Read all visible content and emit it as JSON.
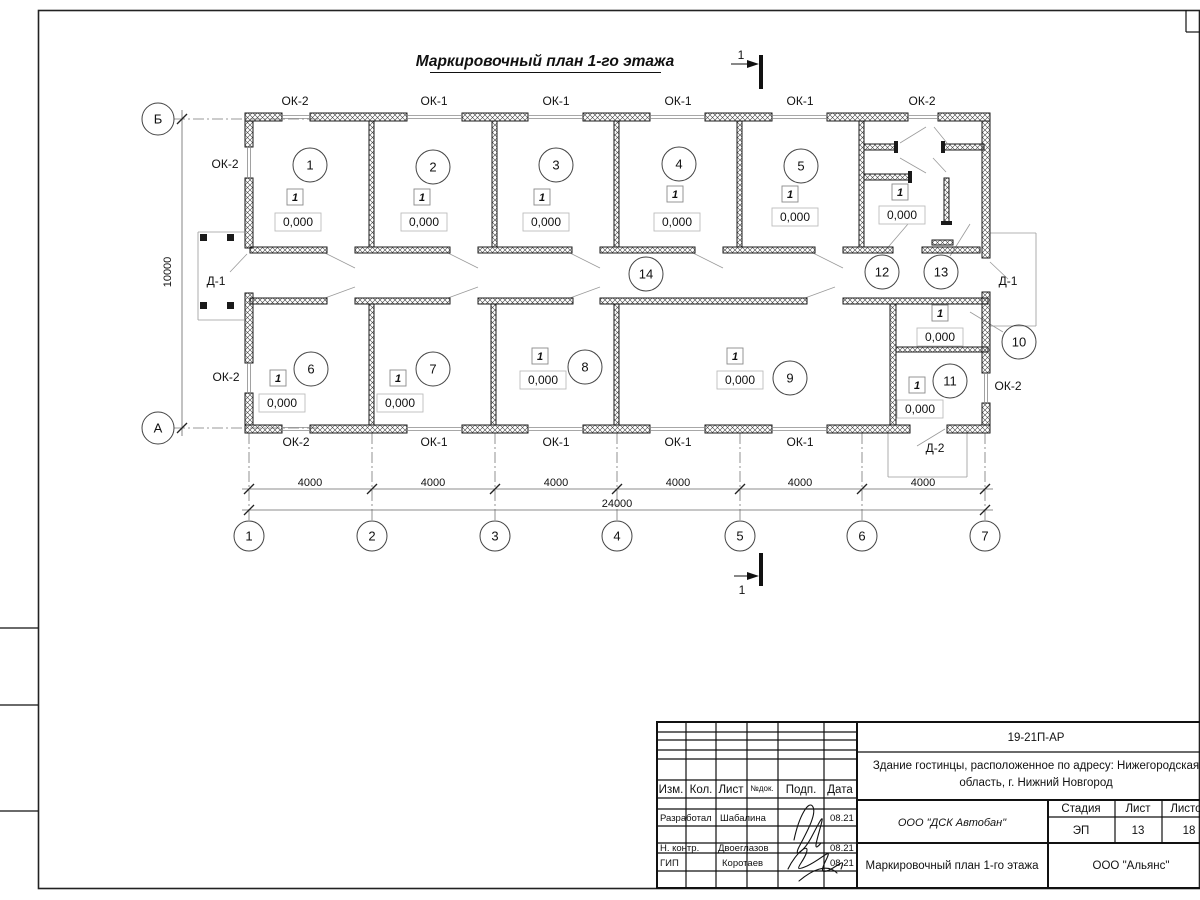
{
  "drawing_title": "Маркировочный план 1-го этажа",
  "section_cut": {
    "label": "1"
  },
  "axes": {
    "cols": [
      {
        "label": "1",
        "x": 249
      },
      {
        "label": "2",
        "x": 372
      },
      {
        "label": "3",
        "x": 495
      },
      {
        "label": "4",
        "x": 617
      },
      {
        "label": "5",
        "x": 740
      },
      {
        "label": "6",
        "x": 862
      },
      {
        "label": "7",
        "x": 985
      }
    ],
    "rows": [
      {
        "label": "Б",
        "y": 119
      },
      {
        "label": "А",
        "y": 428
      }
    ]
  },
  "dims": {
    "bays": [
      {
        "text": "4000",
        "x": 310
      },
      {
        "text": "4000",
        "x": 433
      },
      {
        "text": "4000",
        "x": 556
      },
      {
        "text": "4000",
        "x": 678
      },
      {
        "text": "4000",
        "x": 800
      },
      {
        "text": "4000",
        "x": 923
      }
    ],
    "total": {
      "text": "24000",
      "x": 617,
      "y": 507
    },
    "left": {
      "text": "10000",
      "x": 171,
      "y": 272
    },
    "bay_text_y": 486
  },
  "openings": [
    {
      "text": "ОК-2",
      "x": 295,
      "y": 101
    },
    {
      "text": "ОК-1",
      "x": 434,
      "y": 101
    },
    {
      "text": "ОК-1",
      "x": 556,
      "y": 101
    },
    {
      "text": "ОК-1",
      "x": 678,
      "y": 101
    },
    {
      "text": "ОК-1",
      "x": 800,
      "y": 101
    },
    {
      "text": "ОК-2",
      "x": 922,
      "y": 101
    },
    {
      "text": "ОК-2",
      "x": 296,
      "y": 442
    },
    {
      "text": "ОК-1",
      "x": 434,
      "y": 442
    },
    {
      "text": "ОК-1",
      "x": 556,
      "y": 442
    },
    {
      "text": "ОК-1",
      "x": 678,
      "y": 442
    },
    {
      "text": "ОК-1",
      "x": 800,
      "y": 442
    },
    {
      "text": "ОК-2",
      "x": 225,
      "y": 164
    },
    {
      "text": "ОК-2",
      "x": 226,
      "y": 377
    },
    {
      "text": "Д-1",
      "x": 216,
      "y": 281
    },
    {
      "text": "ОК-2",
      "x": 1008,
      "y": 386
    },
    {
      "text": "Д-1",
      "x": 1008,
      "y": 281
    },
    {
      "text": "Д-2",
      "x": 935,
      "y": 448
    }
  ],
  "rooms": [
    {
      "n": "1",
      "cx": 310,
      "cy": 165,
      "marker": "1",
      "mx": 295,
      "my": 197,
      "elev": "0,000",
      "ex": 298,
      "ey": 222
    },
    {
      "n": "2",
      "cx": 433,
      "cy": 167,
      "marker": "1",
      "mx": 422,
      "my": 197,
      "elev": "0,000",
      "ex": 424,
      "ey": 222
    },
    {
      "n": "3",
      "cx": 556,
      "cy": 165,
      "marker": "1",
      "mx": 542,
      "my": 197,
      "elev": "0,000",
      "ex": 546,
      "ey": 222
    },
    {
      "n": "4",
      "cx": 679,
      "cy": 164,
      "marker": "1",
      "mx": 675,
      "my": 194,
      "elev": "0,000",
      "ex": 677,
      "ey": 222
    },
    {
      "n": "5",
      "cx": 801,
      "cy": 166,
      "marker": "1",
      "mx": 790,
      "my": 194,
      "elev": "0,000",
      "ex": 795,
      "ey": 217
    },
    {
      "n": "6",
      "cx": 311,
      "cy": 369,
      "marker": "1",
      "mx": 278,
      "my": 378,
      "elev": "0,000",
      "ex": 282,
      "ey": 403
    },
    {
      "n": "7",
      "cx": 433,
      "cy": 369,
      "marker": "1",
      "mx": 398,
      "my": 378,
      "elev": "0,000",
      "ex": 400,
      "ey": 403
    },
    {
      "n": "8",
      "cx": 585,
      "cy": 367,
      "marker": "1",
      "mx": 540,
      "my": 356,
      "elev": "0,000",
      "ex": 543,
      "ey": 380
    },
    {
      "n": "9",
      "cx": 790,
      "cy": 378,
      "marker": "1",
      "mx": 735,
      "my": 356,
      "elev": "0,000",
      "ex": 740,
      "ey": 380
    },
    {
      "n": "10",
      "cx": 1019,
      "cy": 342,
      "marker": "1",
      "mx": 940,
      "my": 313,
      "elev": "0,000",
      "ex": 940,
      "ey": 337
    },
    {
      "n": "11",
      "cx": 950,
      "cy": 381,
      "marker": "1",
      "mx": 917,
      "my": 385,
      "elev": "0,000",
      "ex": 920,
      "ey": 409
    },
    {
      "n": "12",
      "cx": 882,
      "cy": 272,
      "marker": "1",
      "mx": 900,
      "my": 192,
      "elev": "0,000",
      "ex": 902,
      "ey": 215
    },
    {
      "n": "13",
      "cx": 941,
      "cy": 272
    },
    {
      "n": "14",
      "cx": 646,
      "cy": 274
    }
  ],
  "plan": {
    "walls": [
      [
        245,
        113,
        37,
        8
      ],
      [
        310,
        113,
        97,
        8
      ],
      [
        462,
        113,
        66,
        8
      ],
      [
        583,
        113,
        67,
        8
      ],
      [
        705,
        113,
        67,
        8
      ],
      [
        827,
        113,
        81,
        8
      ],
      [
        938,
        113,
        52,
        8
      ],
      [
        245,
        425,
        37,
        8
      ],
      [
        310,
        425,
        97,
        8
      ],
      [
        462,
        425,
        66,
        8
      ],
      [
        583,
        425,
        67,
        8
      ],
      [
        705,
        425,
        67,
        8
      ],
      [
        827,
        425,
        83,
        8
      ],
      [
        947,
        425,
        43,
        8
      ],
      [
        245,
        121,
        8,
        26
      ],
      [
        245,
        178,
        8,
        70
      ],
      [
        245,
        293,
        8,
        70
      ],
      [
        245,
        393,
        8,
        32
      ],
      [
        982,
        121,
        8,
        137
      ],
      [
        982,
        292,
        8,
        81
      ],
      [
        982,
        403,
        8,
        22
      ],
      [
        369,
        121,
        5,
        126
      ],
      [
        492,
        121,
        5,
        126
      ],
      [
        614,
        121,
        5,
        126
      ],
      [
        737,
        121,
        5,
        126
      ],
      [
        859,
        121,
        5,
        126
      ],
      [
        250,
        247,
        77,
        6
      ],
      [
        355,
        247,
        95,
        6
      ],
      [
        478,
        247,
        94,
        6
      ],
      [
        600,
        247,
        95,
        6
      ],
      [
        723,
        247,
        92,
        6
      ],
      [
        843,
        247,
        50,
        6
      ],
      [
        922,
        247,
        58,
        6
      ],
      [
        250,
        298,
        77,
        6
      ],
      [
        355,
        298,
        95,
        6
      ],
      [
        478,
        298,
        95,
        6
      ],
      [
        600,
        298,
        207,
        6
      ],
      [
        843,
        298,
        145,
        6
      ],
      [
        369,
        304,
        5,
        121
      ],
      [
        491,
        304,
        5,
        121
      ],
      [
        614,
        304,
        5,
        121
      ],
      [
        890,
        304,
        6,
        121
      ],
      [
        896,
        347,
        92,
        5
      ],
      [
        864,
        144,
        32,
        6
      ],
      [
        864,
        174,
        46,
        6
      ],
      [
        943,
        144,
        41,
        6
      ],
      [
        944,
        178,
        5,
        45
      ],
      [
        932,
        240,
        21,
        5
      ]
    ],
    "caps": [
      [
        894,
        141,
        4,
        12
      ],
      [
        908,
        171,
        4,
        12
      ],
      [
        941,
        141,
        4,
        12
      ],
      [
        941,
        221,
        11,
        4
      ]
    ],
    "win": [
      [
        "h",
        282,
        310,
        113
      ],
      [
        "h",
        407,
        462,
        113
      ],
      [
        "h",
        528,
        583,
        113
      ],
      [
        "h",
        650,
        705,
        113
      ],
      [
        "h",
        772,
        827,
        113
      ],
      [
        "h",
        908,
        938,
        113
      ],
      [
        "h",
        282,
        310,
        425
      ],
      [
        "h",
        407,
        462,
        425
      ],
      [
        "h",
        528,
        583,
        425
      ],
      [
        "h",
        650,
        705,
        425
      ],
      [
        "h",
        772,
        827,
        425
      ],
      [
        "v",
        147,
        178,
        245
      ],
      [
        "v",
        363,
        393,
        245
      ],
      [
        "v",
        373,
        403,
        982
      ]
    ],
    "thin": [
      [
        198,
        232,
        244,
        232
      ],
      [
        198,
        232,
        198,
        320
      ],
      [
        198,
        320,
        244,
        320
      ],
      [
        990,
        233,
        1036,
        233
      ],
      [
        1036,
        233,
        1036,
        326
      ],
      [
        990,
        326,
        1036,
        326
      ],
      [
        888,
        430,
        888,
        477
      ],
      [
        888,
        477,
        967,
        477
      ],
      [
        967,
        430,
        967,
        477
      ],
      [
        230,
        272,
        247,
        254
      ],
      [
        1008,
        279,
        990,
        262
      ],
      [
        917,
        446,
        945,
        429
      ],
      [
        884,
        252,
        908,
        224
      ],
      [
        950,
        256,
        970,
        224
      ],
      [
        1003,
        332,
        970,
        312
      ],
      [
        325,
        253,
        355,
        268
      ],
      [
        448,
        253,
        478,
        268
      ],
      [
        570,
        253,
        600,
        268
      ],
      [
        693,
        253,
        723,
        268
      ],
      [
        813,
        253,
        843,
        268
      ],
      [
        325,
        298,
        355,
        287
      ],
      [
        448,
        298,
        478,
        287
      ],
      [
        570,
        298,
        600,
        287
      ],
      [
        805,
        298,
        835,
        287
      ],
      [
        900,
        143,
        926,
        127
      ],
      [
        934,
        127,
        947,
        143
      ],
      [
        900,
        158,
        926,
        173
      ],
      [
        933,
        158,
        946,
        172
      ]
    ],
    "dash": [
      [
        174,
        119,
        320,
        119
      ],
      [
        174,
        428,
        320,
        428
      ]
    ],
    "squares": [
      [
        200,
        234
      ],
      [
        227,
        234
      ],
      [
        200,
        302
      ],
      [
        227,
        302
      ]
    ]
  },
  "title_block": {
    "code": "19-21П-АР",
    "address_line1": "Здание гостинцы, расположенное по адресу: Нижегородская",
    "address_line2": "область, г. Нижний Новгород",
    "columns": [
      "Изм.",
      "Кол.",
      "Лист",
      "№док.",
      "Подп.",
      "Дата"
    ],
    "roles": [
      {
        "role": "Разработал",
        "name": "Шабалина",
        "date": "08.21"
      },
      {
        "role": "Н. контр.",
        "name": "Двоеглазов",
        "date": "08.21"
      },
      {
        "role": "ГИП",
        "name": "Коротаев",
        "date": "08.21"
      }
    ],
    "org": "ООО \"ДСК Автобан\"",
    "stage_label": "Стадия",
    "sheet_label": "Лист",
    "sheets_label": "Листов",
    "stage": "ЭП",
    "sheet": "13",
    "sheets": "18",
    "sheet_title": "Маркировочный план 1-го этажа",
    "company": "ООО \"Альянс\""
  }
}
